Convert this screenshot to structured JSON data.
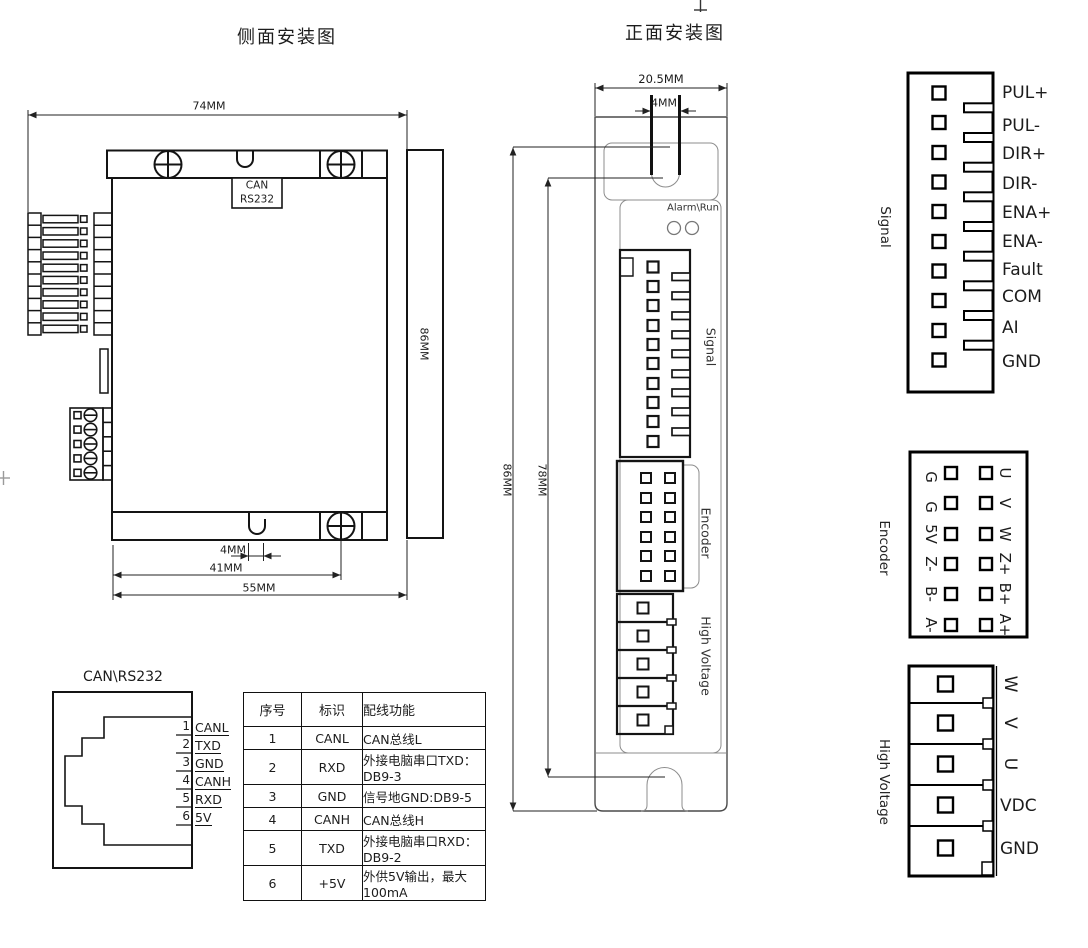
{
  "side_view": {
    "title": "侧面安装图",
    "port_line1": "CAN",
    "port_line2": "RS232",
    "dims": {
      "width": "74MM",
      "height": "86MM",
      "notch": "4MM",
      "hole_offset": "41MM",
      "depth": "55MM"
    }
  },
  "front_view": {
    "title": "正面安装图",
    "dims": {
      "width": "20.5MM",
      "slot": "4MM",
      "height_outer": "86MM",
      "height_inner": "78MM"
    },
    "led_label": "Alarm\\Run",
    "port_labels": {
      "signal": "Signal",
      "encoder": "Encoder",
      "high_voltage": "High Voltage"
    }
  },
  "signal_connector": {
    "label": "Signal",
    "pins": [
      "PUL+",
      "PUL-",
      "DIR+",
      "DIR-",
      "ENA+",
      "ENA-",
      "Fault",
      "COM",
      "AI",
      "GND"
    ]
  },
  "encoder_connector": {
    "label": "Encoder",
    "left_pins": [
      "G",
      "G",
      "5V",
      "Z-",
      "B-",
      "A-"
    ],
    "right_pins": [
      "U",
      "V",
      "W",
      "Z+",
      "B+",
      "A+"
    ]
  },
  "high_voltage_connector": {
    "label": "High Voltage",
    "pins_rotated": [
      "W",
      "V",
      "U"
    ],
    "pins_horizontal": [
      "VDC",
      "GND"
    ]
  },
  "rj_connector": {
    "title": "CAN\\RS232",
    "pins": [
      {
        "num": "1",
        "label": "CANL"
      },
      {
        "num": "2",
        "label": "TXD"
      },
      {
        "num": "3",
        "label": "GND"
      },
      {
        "num": "4",
        "label": "CANH"
      },
      {
        "num": "5",
        "label": "RXD"
      },
      {
        "num": "6",
        "label": "5V"
      }
    ]
  },
  "wiring_table": {
    "headers": [
      "序号",
      "标识",
      "配线功能"
    ],
    "rows": [
      [
        "1",
        "CANL",
        "CAN总线L"
      ],
      [
        "2",
        "RXD",
        "外接电脑串口TXD：DB9-3"
      ],
      [
        "3",
        "GND",
        "信号地GND:DB9-5"
      ],
      [
        "4",
        "CANH",
        "CAN总线H"
      ],
      [
        "5",
        "TXD",
        "外接电脑串口RXD：DB9-2"
      ],
      [
        "6",
        "+5V",
        "外供5V输出，最大100mA"
      ]
    ]
  }
}
